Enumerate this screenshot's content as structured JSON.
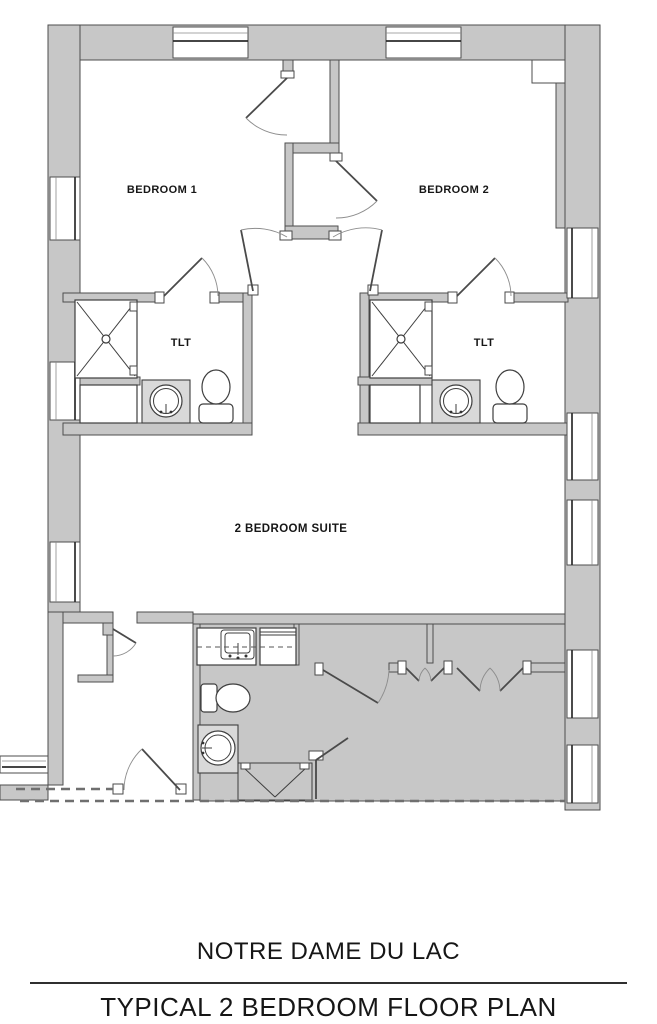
{
  "document": {
    "type": "architectural floor plan drawing"
  },
  "colors": {
    "wall_fill": "#c7c7c7",
    "wall_line": "#4e4e4e",
    "fixture_line": "#3e3e3e",
    "dashed_line": "#6f6f6f",
    "text": "#161616",
    "page_bg": "#ffffff"
  },
  "plan": {
    "rooms": [
      {
        "id": "bedroom-1",
        "label": "BEDROOM 1"
      },
      {
        "id": "bedroom-2",
        "label": "BEDROOM 2"
      },
      {
        "id": "toilet-1",
        "label": "TLT"
      },
      {
        "id": "toilet-2",
        "label": "TLT"
      },
      {
        "id": "suite",
        "label": "2 BEDROOM SUITE"
      }
    ],
    "fixtures": [
      {
        "room": "toilet-1",
        "items": [
          "shower",
          "vanity-sink",
          "toilet"
        ]
      },
      {
        "room": "toilet-2",
        "items": [
          "shower",
          "vanity-sink",
          "toilet"
        ]
      },
      {
        "room": "suite",
        "items": [
          "kitchen-sink",
          "range-counter",
          "toilet",
          "round-sink",
          "shower"
        ]
      }
    ]
  },
  "title_block": {
    "project_name": "NOTRE DAME DU LAC",
    "sheet_title": "TYPICAL 2 BEDROOM FLOOR PLAN"
  }
}
